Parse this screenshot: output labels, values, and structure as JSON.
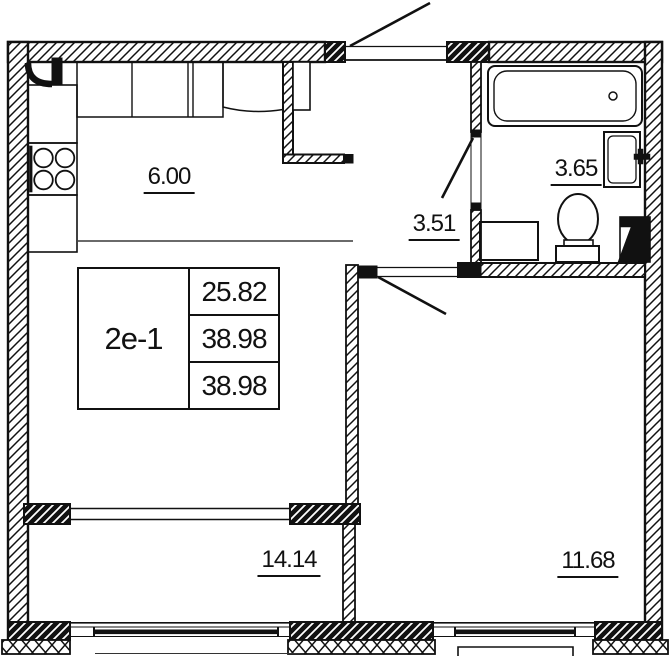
{
  "plan": {
    "unit": {
      "label": "2e-1"
    },
    "stats": [
      "25.82",
      "38.98",
      "38.98"
    ],
    "rooms": [
      {
        "name": "kitchen",
        "area": "6.00"
      },
      {
        "name": "hallway",
        "area": "3.51"
      },
      {
        "name": "bathroom",
        "area": "3.65"
      },
      {
        "name": "living-room",
        "area": "14.14"
      },
      {
        "name": "bedroom",
        "area": "11.68"
      }
    ],
    "fixtures": [
      "bathtub",
      "sink",
      "toilet",
      "washing-machine",
      "vent-shaft",
      "stove",
      "kitchen-counter",
      "fridge-cabinet",
      "wardrobe",
      "corner-duct"
    ],
    "colors": {
      "ink": "#111111",
      "background": "#ffffff"
    }
  }
}
